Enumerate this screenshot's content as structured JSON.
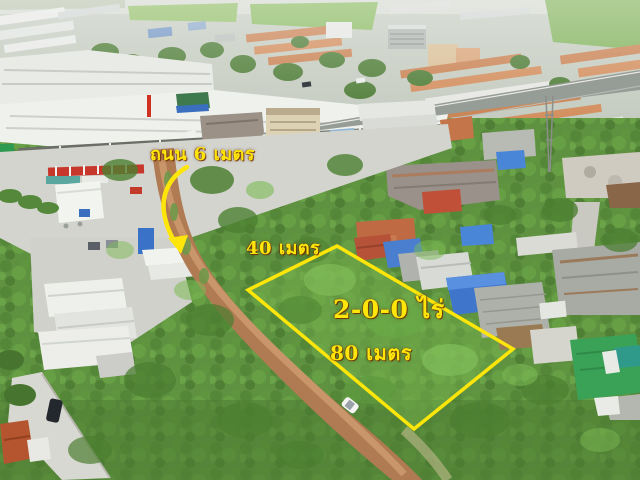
{
  "overlay": {
    "accent_color": "#ffe60a",
    "labels": {
      "road": "ถนน 6 เมตร",
      "width": "40 เมตร",
      "area": "2-0-0 ไร่",
      "length": "80 เมตร"
    },
    "plot_polygon_points": "337,246 513,349 414,429 248,290",
    "arrow_path": "M187,167 C168,178 160,197 165,218 C168,230 172,238 176,243",
    "arrowhead_points": "181,254 168,238 188,235"
  }
}
